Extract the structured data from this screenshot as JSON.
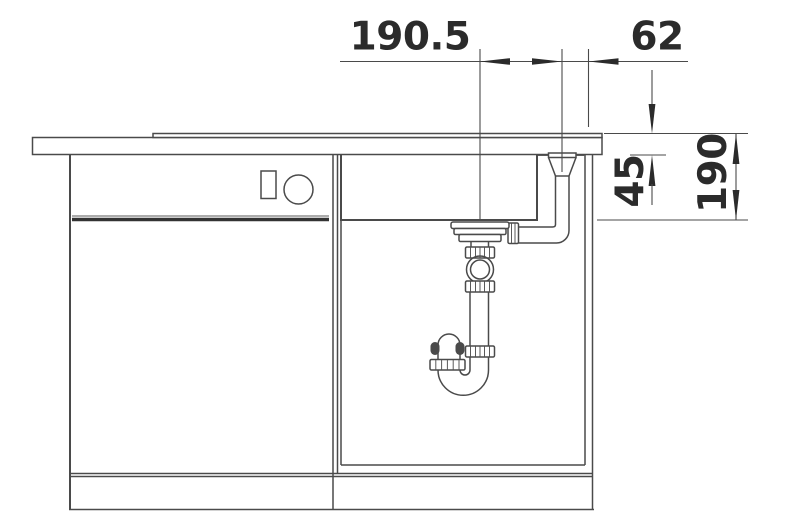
{
  "diagram": {
    "kind": "technical-drawing",
    "subject": "kitchen sink base cabinet cross-section with drain siphon and overflow pipe",
    "units_implied": "mm",
    "dimensions": {
      "drain_to_overflow": "190.5",
      "overflow_to_edge": "62",
      "overflow_depth": "45",
      "bowl_depth": "190"
    },
    "colors": {
      "bg": "#ffffff",
      "line": "#4a4a4a",
      "text": "#2b2b2b",
      "thin": "#5a5a5a"
    }
  }
}
